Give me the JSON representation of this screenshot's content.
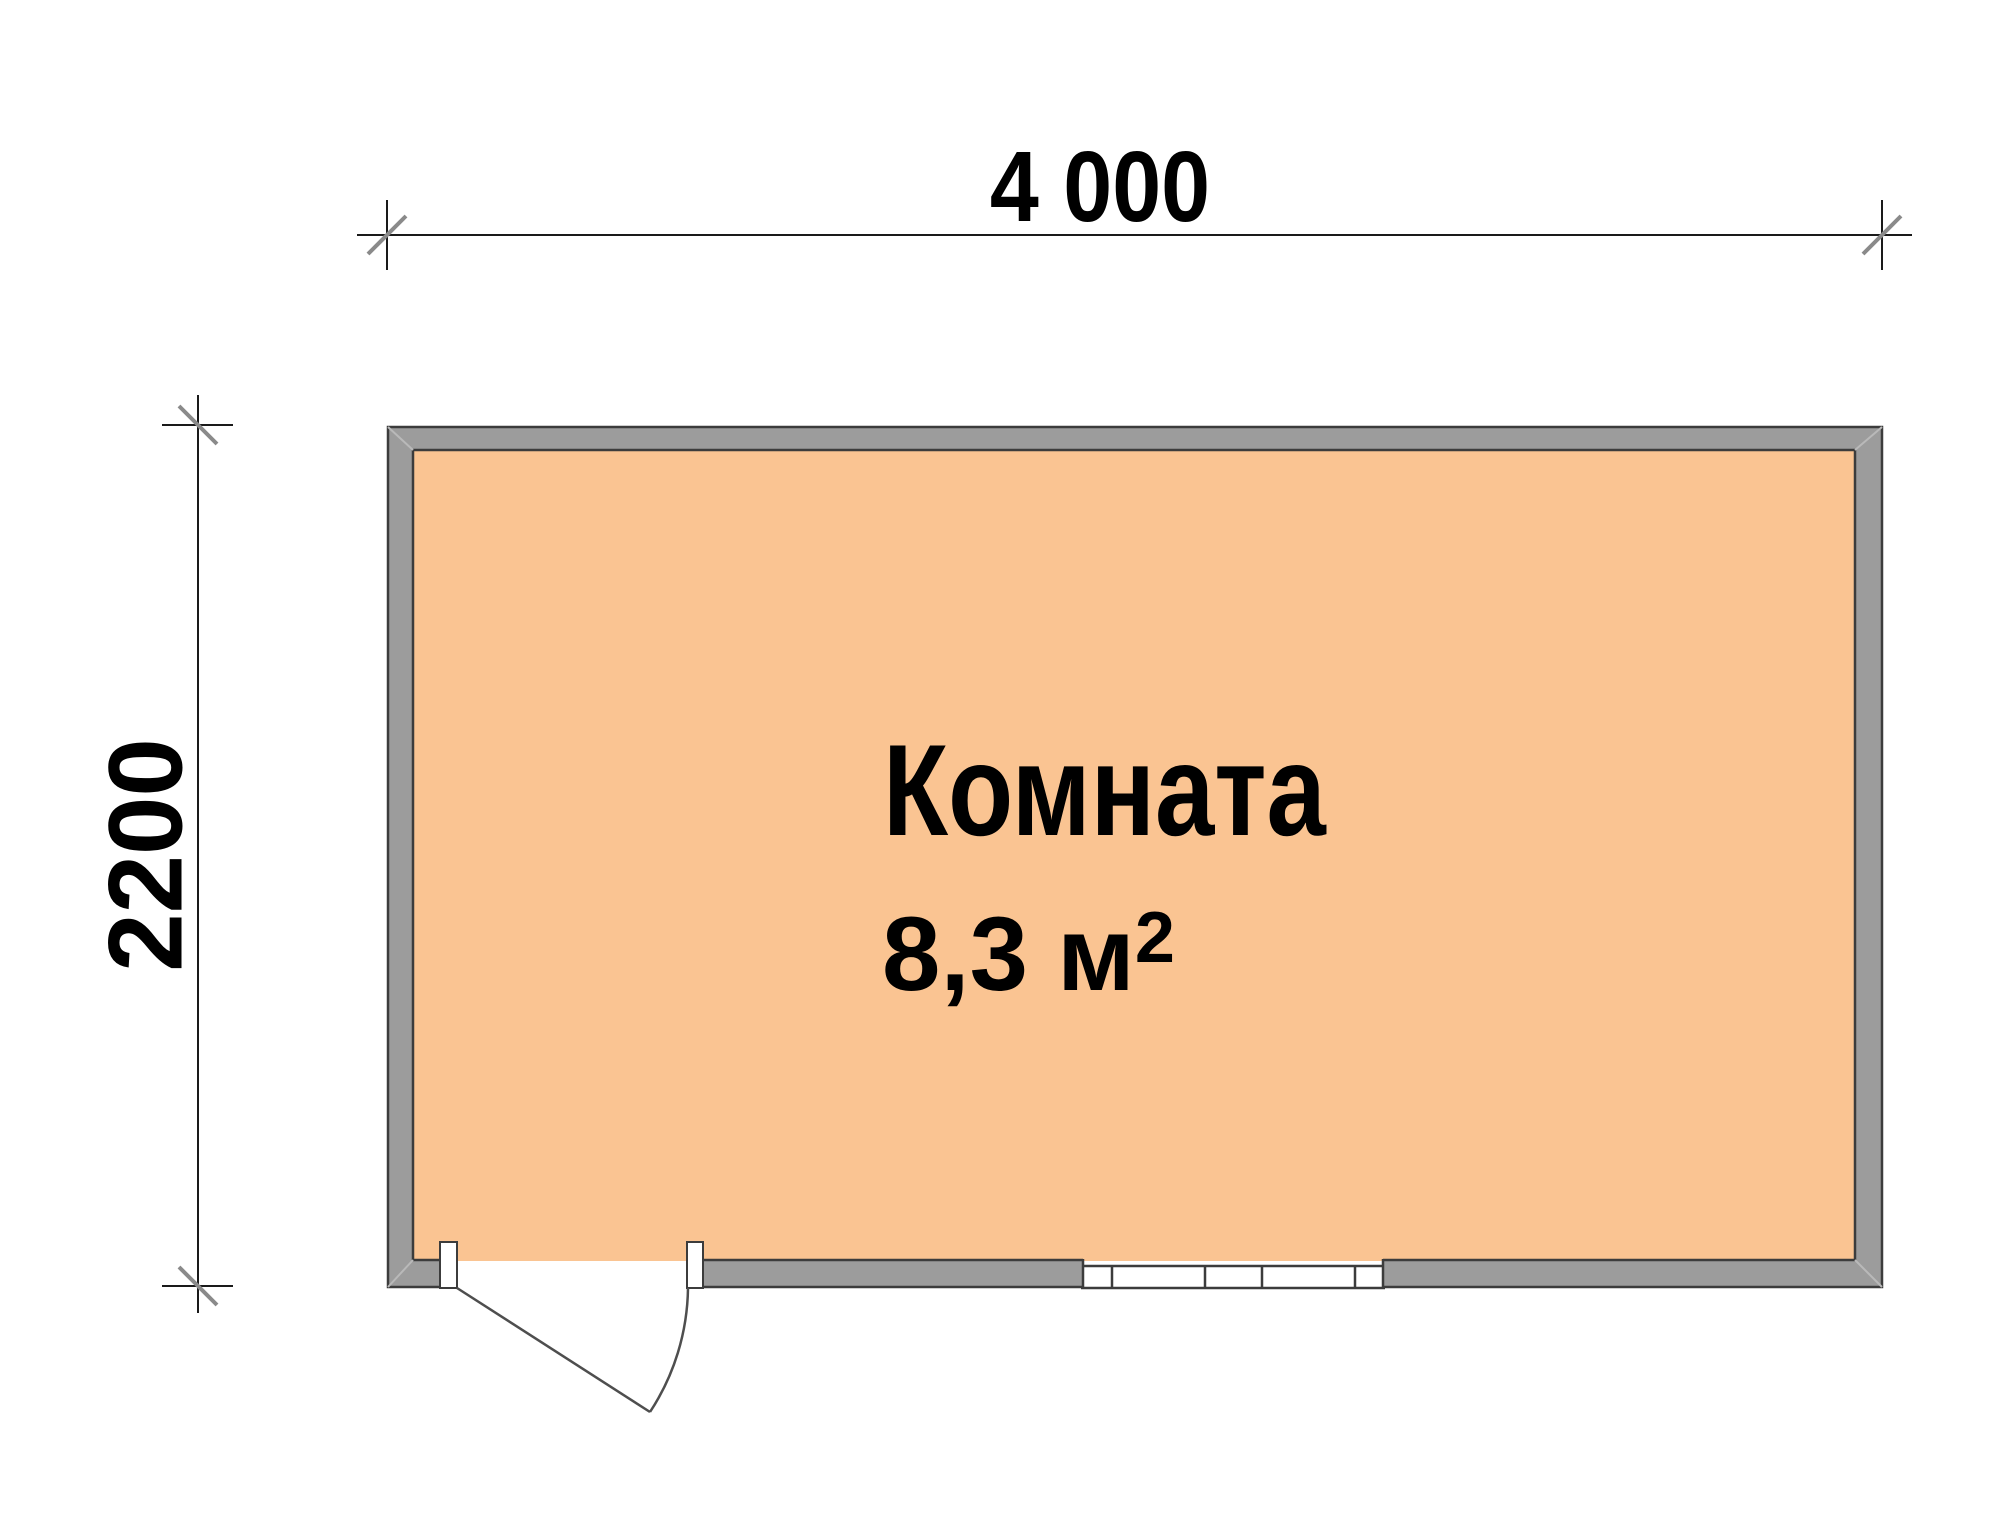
{
  "page": {
    "type": "floor-plan",
    "background": "#FFFFFF"
  },
  "dimensions": {
    "width_label": "4 000",
    "height_label": "2200"
  },
  "room": {
    "name": "Комната",
    "area_value": "8,3 м",
    "area_exponent": "2"
  },
  "colors": {
    "room_fill": "#FAC492",
    "wall_fill": "#9C9C9C",
    "outline": "#3C3C3C",
    "miter": "#B9B9B9",
    "dim_line": "#1A1A1A",
    "tick_slash": "#8A8A8A",
    "door_line": "#4E4E4E",
    "opening_fill": "#FFFFFF"
  }
}
